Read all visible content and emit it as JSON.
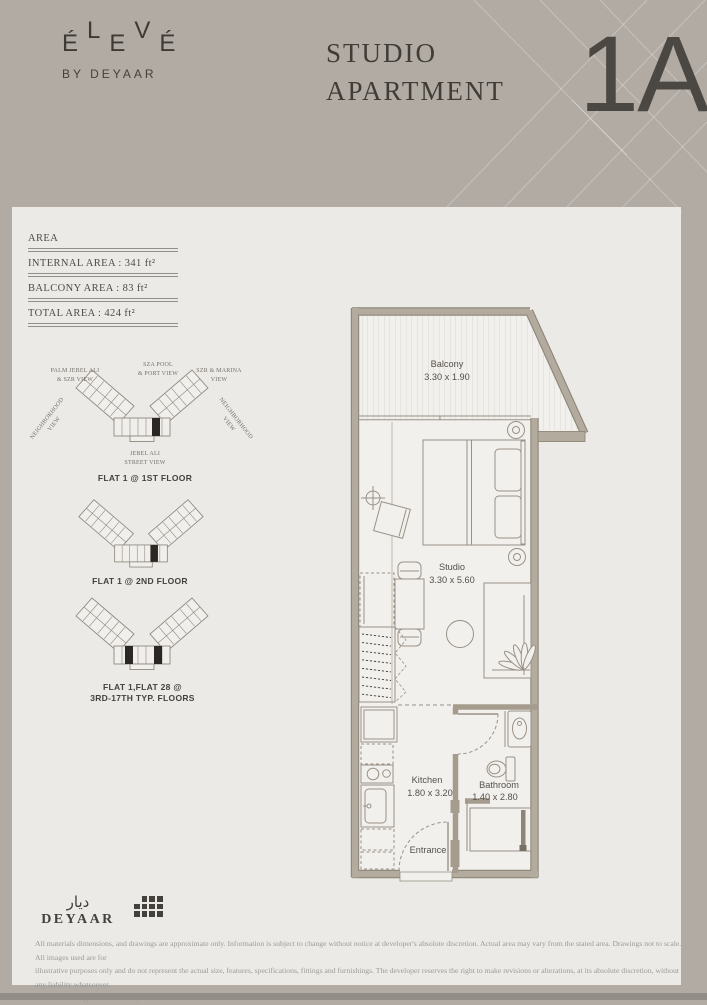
{
  "header": {
    "logo": {
      "letters": [
        "É",
        "L",
        "E",
        "V",
        "É"
      ],
      "byline": "BY DEYAAR"
    },
    "title_line1": "STUDIO",
    "title_line2": "APARTMENT",
    "unit": "1A"
  },
  "area_box": {
    "heading": "AREA",
    "rows": [
      {
        "label": "INTERNAL AREA : 341 ft²"
      },
      {
        "label": "BALCONY AREA : 83 ft²"
      },
      {
        "label": "TOTAL AREA : 424 ft²"
      }
    ]
  },
  "key_plans": {
    "views": {
      "top_left_1": "PALM JEBEL ALI",
      "top_left_2": "& SZR VIEW",
      "top_center_1": "SZA POOL",
      "top_center_2": "& PORT VIEW",
      "top_right_1": "SZR & MARINA",
      "top_right_2": "VIEW",
      "left_side_1": "NEIGHBORHOOD",
      "left_side_2": "VIEW",
      "right_side_1": "NEIGHBORHOOD",
      "right_side_2": "VIEW",
      "bottom_1": "JEBEL ALI",
      "bottom_2": "STREET VIEW"
    },
    "captions": {
      "plan1": "FLAT 1 @ 1ST FLOOR",
      "plan2": "FLAT 1 @ 2ND FLOOR",
      "plan3_line1": "FLAT 1,FLAT 28 @",
      "plan3_line2": "3RD-17TH TYP. FLOORS"
    }
  },
  "floor_plan": {
    "balcony_name": "Balcony",
    "balcony_dims": "3.30 x 1.90",
    "studio_name": "Studio",
    "studio_dims": "3.30 x 5.60",
    "kitchen_name": "Kitchen",
    "kitchen_dims": "1.80 x 3.20",
    "bathroom_name": "Bathroom",
    "bathroom_dims": "1.40 x 2.80",
    "entrance_name": "Entrance"
  },
  "footer": {
    "brand_arabic": "ديار",
    "brand_latin": "DEYAAR",
    "disclaimer_line1": "All materials dimensions, and drawings are approximate only. Information is subject to change without notice at developer's absolute discretion. Actual area may vary from the stated area. Drawings not to scale. All images used are for",
    "disclaimer_line2": "illustrative purposes only and do not represent the actual size, features, specifications, fittings and furnishings. The developer reserves the right to make revisions or alterations, at its absolute discretion, without any liability whatsoever.",
    "disclaimer_line3": "Key Plans are approximate and symbolic."
  },
  "colors": {
    "page_bg": "#B1ABA4",
    "panel_bg": "#ECEAE7",
    "wall_fill": "#B3AB9D",
    "wall_edge": "#8D8578",
    "plan_line": "#9A9186",
    "marker": "#2A2724",
    "text_dark": "#403C37",
    "text_muted": "#9A9A98"
  }
}
